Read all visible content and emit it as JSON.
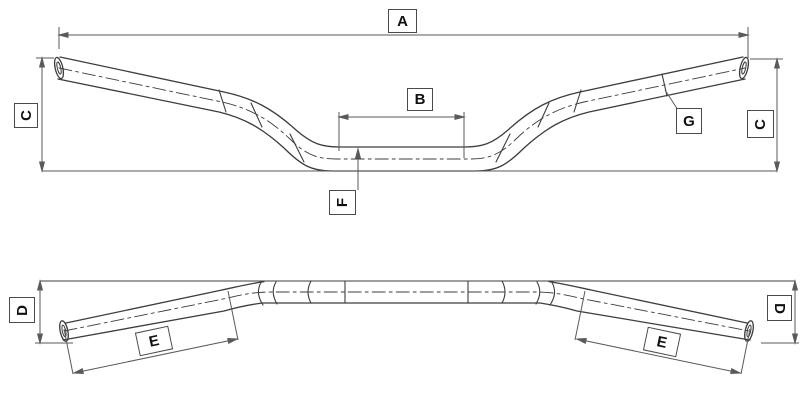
{
  "drawing": {
    "kind": "technical-dimension-drawing",
    "subject": "handlebar-two-view",
    "colors": {
      "background": "#ffffff",
      "outline": "#3d3d3d",
      "dimension_line": "#5a5a5a",
      "label_border": "#4a4a4a",
      "label_text": "#101010"
    },
    "labels": {
      "a": "A",
      "b": "B",
      "c_left": "C",
      "c_right": "C",
      "f": "F",
      "g": "G",
      "d_left": "D",
      "d_right": "D",
      "e_left": "E",
      "e_right": "E"
    }
  }
}
